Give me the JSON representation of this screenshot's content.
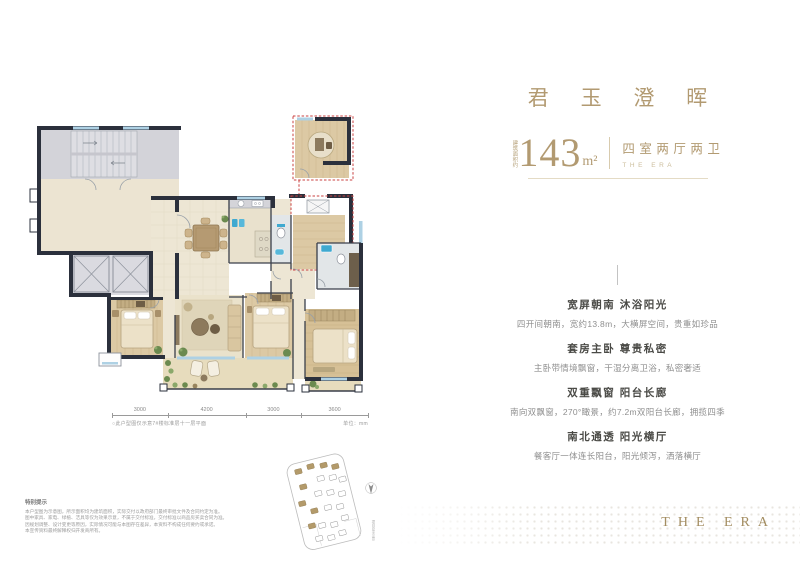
{
  "header": {
    "title": "君 玉 澄 晖",
    "area": {
      "prefix_vertical": "建筑面积约",
      "value": "143",
      "unit": "m²"
    },
    "layout_cn": "四室两厅两卫",
    "layout_en": "THE ERA"
  },
  "features": [
    {
      "heading": "宽屏朝南 沐浴阳光",
      "body": "四开间朝南，宽约13.8m，大横屏空间，贵重如珍品"
    },
    {
      "heading": "套房主卧 尊贵私密",
      "body": "主卧带情境飘窗，干湿分离卫浴，私密奢适"
    },
    {
      "heading": "双重飘窗 阳台长廊",
      "body": "南向双飘窗，270°瞰景，约7.2m双阳台长廊，拥揽四季"
    },
    {
      "heading": "南北通透 阳光横厅",
      "body": "餐客厅一体连长阳台，阳光倾泻，洒落横厅"
    }
  ],
  "plan": {
    "dim_labels": [
      "3000",
      "4200",
      "3000",
      "3600"
    ],
    "note": "○此户型图仅示意7#楼标准层十一层平面",
    "unit_note": "单位：mm"
  },
  "site_map": {
    "caption_vertical": "项目总平示意"
  },
  "disclaimer": {
    "title": "特别提示",
    "lines": [
      "本户型图为示意图，所示面积均为建筑面积，实际交付以政府部门最终审批文件及合同约定为准。",
      "图中家具、家电、绿植、洁具等仅为效果示意，不属于交付标准，交付标准以商品房买卖合同为准。",
      "因规划调整、设计变更等原因，实际情况可能与本图存在差异，本资料不构成任何要约或承诺。",
      "本宣传资料最终解释权归开发商所有。"
    ]
  },
  "brand": {
    "name": "THE ERA"
  },
  "colors": {
    "accent_gold": "#b29a71",
    "wall_dark": "#2b303c",
    "highlight_red": "#c94040",
    "window_blue": "#aed1e4",
    "wood": "#dcc9a4",
    "fixture_blue": "#3fa9d0",
    "plant_green": "#6b8a4f"
  }
}
